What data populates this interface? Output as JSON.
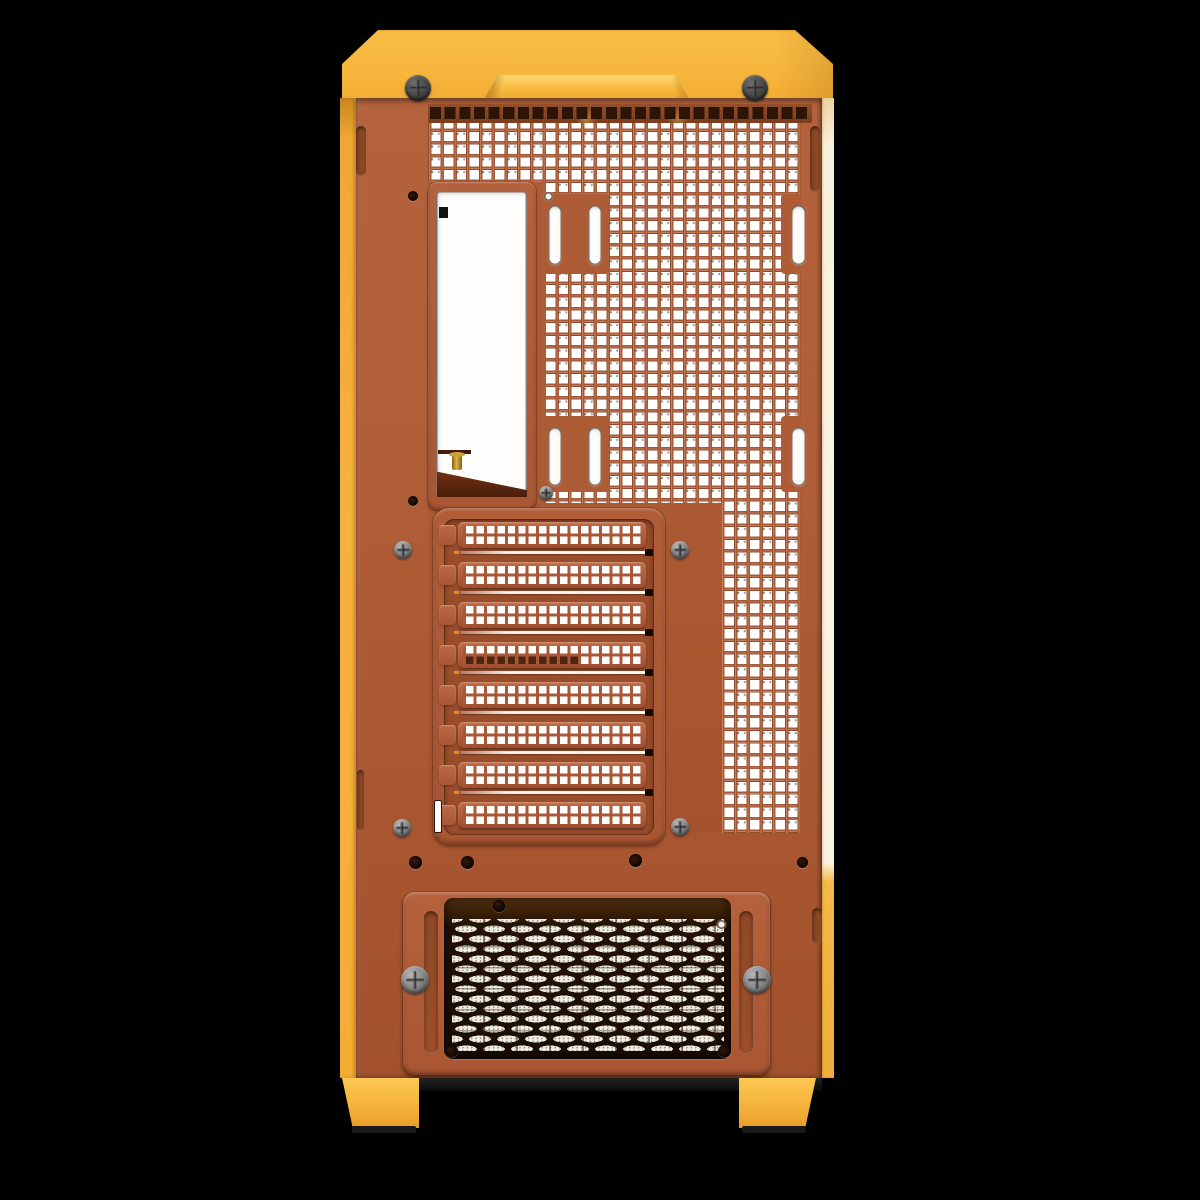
{
  "scene": {
    "subject": "pc-case-rear-panel-render",
    "background_color": "#000000"
  },
  "colors": {
    "cap_yellow": "#f7b73e",
    "cap_highlight": "#ffd873",
    "side_strip_yellow": "#f3ae36",
    "side_strip_cream": "#fbf3e0",
    "panel_orange": "#b05e38",
    "mesh_web_orange": "#a65939",
    "mesh_hole_white": "#ffffff",
    "vent_dark_brown": "#2c1507",
    "expansion_recess": "#9a4d2b",
    "psu_recess_brown": "#221104",
    "psu_pill_white": "#efece4",
    "screw_gray": "#8a8a8a",
    "screw_dark_gray": "#474747",
    "brass": "#e0b34a",
    "bracket_brown": "#4a1f0a",
    "foot_yellow": "#f9bd49",
    "foot_pad_black": "#191919"
  },
  "counts": {
    "top_vent_squares": 26,
    "expansion_slot_covers": 8,
    "dark_interior_cover_index": 3,
    "cap_thumbscrews": 2,
    "psu_thumbscrews": 2,
    "fan_mount_slots": 6
  },
  "build": [
    {
      "host": "#stage",
      "cls": "notch-patch",
      "name": "mesh-notch-patch",
      "items": [
        {
          "l": 543,
          "t": 194,
          "w": 66,
          "h": 80
        },
        {
          "l": 781,
          "t": 194,
          "w": 20,
          "h": 80
        },
        {
          "l": 543,
          "t": 416,
          "w": 66,
          "h": 76
        },
        {
          "l": 781,
          "t": 416,
          "w": 20,
          "h": 76
        }
      ]
    },
    {
      "host": "#stage",
      "cls": "slot-cover",
      "name": "expansion-slot-cover",
      "kind": "cover",
      "items": [
        {
          "l": 458,
          "t": 522,
          "w": 188,
          "h": 26
        },
        {
          "l": 458,
          "t": 562,
          "w": 188,
          "h": 26
        },
        {
          "l": 458,
          "t": 602,
          "w": 188,
          "h": 26
        },
        {
          "l": 458,
          "t": 642,
          "w": 188,
          "h": 26,
          "dark": true
        },
        {
          "l": 458,
          "t": 682,
          "w": 188,
          "h": 26
        },
        {
          "l": 458,
          "t": 722,
          "w": 188,
          "h": 26
        },
        {
          "l": 458,
          "t": 762,
          "w": 188,
          "h": 26
        },
        {
          "l": 458,
          "t": 802,
          "w": 188,
          "h": 26
        }
      ]
    },
    {
      "host": "#stage",
      "cls": "tab",
      "name": "pci-bracket-tab",
      "items": [
        {
          "l": 439,
          "t": 525,
          "w": 17,
          "h": 20
        },
        {
          "l": 439,
          "t": 565,
          "w": 17,
          "h": 20
        },
        {
          "l": 439,
          "t": 605,
          "w": 17,
          "h": 20
        },
        {
          "l": 439,
          "t": 645,
          "w": 17,
          "h": 20
        },
        {
          "l": 439,
          "t": 685,
          "w": 17,
          "h": 20
        },
        {
          "l": 439,
          "t": 725,
          "w": 17,
          "h": 20
        },
        {
          "l": 439,
          "t": 765,
          "w": 17,
          "h": 20
        },
        {
          "l": 439,
          "t": 805,
          "w": 17,
          "h": 20
        }
      ]
    },
    {
      "host": "#stage",
      "cls": "sep-line",
      "name": "slot-separator-gap",
      "items": [
        {
          "l": 460,
          "t": 551,
          "w": 192,
          "h": 3
        },
        {
          "l": 460,
          "t": 591,
          "w": 192,
          "h": 3
        },
        {
          "l": 460,
          "t": 631,
          "w": 192,
          "h": 3
        },
        {
          "l": 460,
          "t": 671,
          "w": 192,
          "h": 3
        },
        {
          "l": 460,
          "t": 711,
          "w": 192,
          "h": 3
        },
        {
          "l": 460,
          "t": 751,
          "w": 192,
          "h": 3
        },
        {
          "l": 460,
          "t": 791,
          "w": 192,
          "h": 3
        }
      ]
    },
    {
      "host": "#stage",
      "cls": "end-square",
      "name": "slot-latch-hole",
      "items": [
        {
          "l": 645,
          "t": 549,
          "w": 8,
          "h": 7
        },
        {
          "l": 645,
          "t": 589,
          "w": 8,
          "h": 7
        },
        {
          "l": 645,
          "t": 629,
          "w": 8,
          "h": 7
        },
        {
          "l": 645,
          "t": 669,
          "w": 8,
          "h": 7
        },
        {
          "l": 645,
          "t": 709,
          "w": 8,
          "h": 7
        },
        {
          "l": 645,
          "t": 749,
          "w": 8,
          "h": 7
        },
        {
          "l": 645,
          "t": 789,
          "w": 8,
          "h": 7
        }
      ]
    },
    {
      "host": "#stage",
      "cls": "tick",
      "name": "slot-gap-tick",
      "items": [
        {
          "l": 454,
          "t": 551,
          "w": 5,
          "h": 3
        },
        {
          "l": 454,
          "t": 591,
          "w": 5,
          "h": 3
        },
        {
          "l": 454,
          "t": 631,
          "w": 5,
          "h": 3
        },
        {
          "l": 454,
          "t": 671,
          "w": 5,
          "h": 3
        },
        {
          "l": 454,
          "t": 711,
          "w": 5,
          "h": 3
        },
        {
          "l": 454,
          "t": 751,
          "w": 5,
          "h": 3
        },
        {
          "l": 454,
          "t": 791,
          "w": 5,
          "h": 3
        }
      ]
    },
    {
      "host": "#stage",
      "cls": "fan-slot",
      "name": "fan-mount-slot",
      "items": [
        {
          "l": 548,
          "t": 205,
          "w": 14,
          "h": 60
        },
        {
          "l": 588,
          "t": 205,
          "w": 14,
          "h": 60
        },
        {
          "l": 791,
          "t": 205,
          "w": 15,
          "h": 60
        },
        {
          "l": 548,
          "t": 427,
          "w": 14,
          "h": 59
        },
        {
          "l": 588,
          "t": 427,
          "w": 14,
          "h": 59
        },
        {
          "l": 791,
          "t": 427,
          "w": 15,
          "h": 59
        }
      ]
    },
    {
      "host": "#stage",
      "cls": "edge-recess",
      "name": "edge-recess-slot",
      "items": [
        {
          "l": 810,
          "t": 126,
          "w": 10,
          "h": 66
        },
        {
          "l": 356,
          "t": 126,
          "w": 10,
          "h": 50
        },
        {
          "l": 357,
          "t": 770,
          "w": 7,
          "h": 60
        },
        {
          "l": 812,
          "t": 908,
          "w": 10,
          "h": 36
        }
      ]
    },
    {
      "host": "#stage",
      "cls": "mini-slot",
      "name": "cable-slot",
      "items": [
        {
          "l": 434,
          "t": 800,
          "w": 6,
          "h": 31
        }
      ]
    },
    {
      "host": "#stage",
      "cls": "plate-slot",
      "name": "psu-plate-adjust-slot",
      "items": [
        {
          "l": 424,
          "t": 911,
          "w": 14,
          "h": 143
        },
        {
          "l": 739,
          "t": 911,
          "w": 14,
          "h": 143
        }
      ]
    },
    {
      "host": "#stage",
      "cls": "screw dark",
      "name": "top-cover-thumbscrew",
      "items": [
        {
          "l": 405,
          "t": 75,
          "w": 26,
          "h": 26
        },
        {
          "l": 742,
          "t": 75,
          "w": 26,
          "h": 26
        }
      ]
    },
    {
      "host": "#stage",
      "cls": "screw",
      "name": "psu-thumbscrew",
      "items": [
        {
          "l": 401,
          "t": 966,
          "w": 28,
          "h": 28
        },
        {
          "l": 743,
          "t": 966,
          "w": 28,
          "h": 28
        }
      ]
    },
    {
      "host": "#stage",
      "cls": "screw",
      "name": "panel-screw",
      "items": [
        {
          "l": 394,
          "t": 541,
          "w": 18,
          "h": 18
        },
        {
          "l": 393,
          "t": 819,
          "w": 18,
          "h": 18
        },
        {
          "l": 671,
          "t": 541,
          "w": 18,
          "h": 18
        },
        {
          "l": 671,
          "t": 818,
          "w": 18,
          "h": 18
        },
        {
          "l": 539,
          "t": 486,
          "w": 14,
          "h": 14
        }
      ]
    },
    {
      "host": "#stage",
      "cls": "hole-dark",
      "name": "screw-hole",
      "items": [
        {
          "l": 408,
          "t": 191,
          "w": 10,
          "h": 10
        },
        {
          "l": 408,
          "t": 496,
          "w": 10,
          "h": 10
        },
        {
          "l": 409,
          "t": 856,
          "w": 13,
          "h": 13
        },
        {
          "l": 461,
          "t": 856,
          "w": 13,
          "h": 13
        },
        {
          "l": 629,
          "t": 854,
          "w": 13,
          "h": 13
        },
        {
          "l": 797,
          "t": 857,
          "w": 11,
          "h": 11
        },
        {
          "l": 493,
          "t": 900,
          "w": 12,
          "h": 12
        },
        {
          "l": 445,
          "t": 1045,
          "w": 13,
          "h": 12
        },
        {
          "l": 718,
          "t": 1045,
          "w": 13,
          "h": 12
        }
      ]
    },
    {
      "host": "#stage",
      "cls": "hole-white",
      "name": "through-hole",
      "items": [
        {
          "l": 544,
          "t": 192,
          "w": 9,
          "h": 9
        },
        {
          "l": 717,
          "t": 920,
          "w": 9,
          "h": 9
        }
      ]
    }
  ]
}
